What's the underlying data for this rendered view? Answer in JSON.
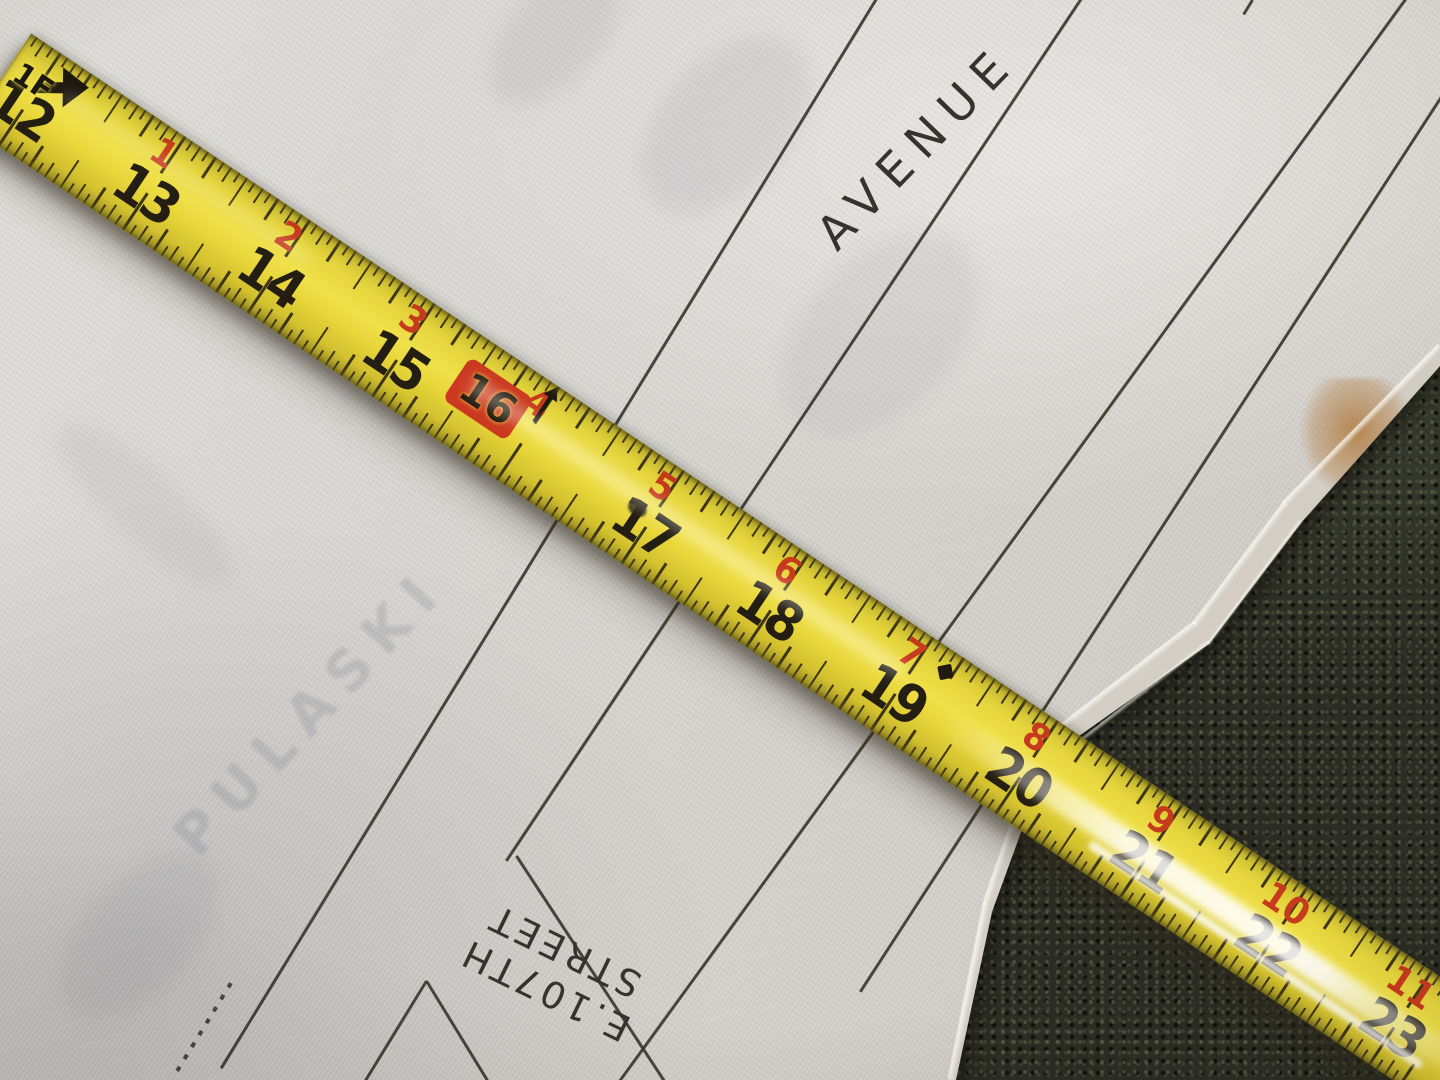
{
  "tape_measure": {
    "foot_marker_label": "1F",
    "stud_box_label": "16",
    "black_inch_numbers": [
      12,
      13,
      14,
      15,
      17,
      18,
      19,
      20,
      21,
      22,
      23
    ],
    "red_inch_numbers": [
      {
        "label": "1",
        "inch": 13
      },
      {
        "label": "2",
        "inch": 14
      },
      {
        "label": "3",
        "inch": 15
      },
      {
        "label": "4",
        "inch": 16
      },
      {
        "label": "5",
        "inch": 17
      },
      {
        "label": "6",
        "inch": 18
      },
      {
        "label": "7",
        "inch": 19
      },
      {
        "label": "8",
        "inch": 20
      },
      {
        "label": "9",
        "inch": 21
      },
      {
        "label": "10",
        "inch": 22
      },
      {
        "label": "11",
        "inch": 23
      }
    ],
    "colors": {
      "blade_yellow": "#e8d73c",
      "print_black": "#241e12",
      "print_red": "#c63a1d",
      "stud_box_red": "#cb3a20"
    }
  },
  "blueprint": {
    "avenue_label": "AVENUE",
    "street_label_line1": "E.107TH",
    "street_label_line2": "STREET",
    "bleedthrough_label": "PULASKI",
    "ink_color": "#3a3830",
    "paper_color": "#d6d4d0"
  },
  "background": {
    "carpet_color": "#2b2d24",
    "stain_color": "#b07a3e"
  }
}
